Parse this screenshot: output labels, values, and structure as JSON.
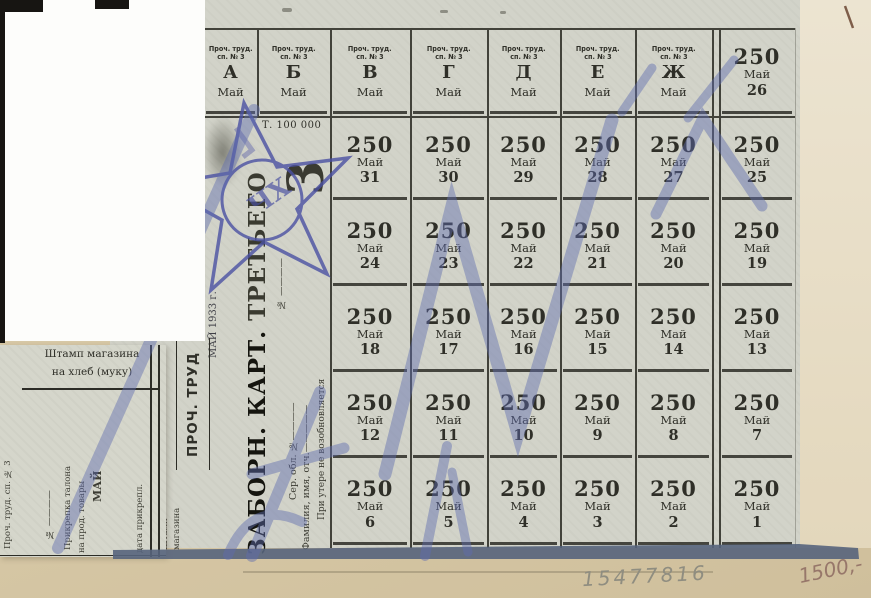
{
  "grid": {
    "small_header_line1": "Проч. труд.",
    "small_header_line2": "сп. № 3",
    "month": "Май",
    "ration": "250",
    "letters": [
      "А",
      "Б",
      "В",
      "Г",
      "Д",
      "Е",
      "Ж"
    ],
    "header_last_day": "26",
    "rows": [
      [
        "31",
        "30",
        "29",
        "28",
        "27",
        "25"
      ],
      [
        "24",
        "23",
        "22",
        "21",
        "20",
        "19"
      ],
      [
        "18",
        "17",
        "16",
        "15",
        "14",
        "13"
      ],
      [
        "12",
        "11",
        "10",
        "9",
        "8",
        "7"
      ],
      [
        "6",
        "5",
        "4",
        "3",
        "2",
        "1"
      ]
    ]
  },
  "title_strip": {
    "print_run": "Т. 100 000",
    "big_numeral": "3",
    "title_part1": "ЗАБОРН. КАРТ.",
    "title_part2": " ТРЕТЬЕГО",
    "number_line": "№ ————",
    "series_line": "Сер. обл. №————",
    "name_line": "Фамилия, имя, отч.—————",
    "warning_line": "При утере не возобновляется"
  },
  "middle": {
    "date_text": "МАЙ 1933 г.",
    "proch_trud": "ПРОЧ. ТРУД",
    "shop_stamp_line1": "Штамп",
    "shop_stamp_line2": "магазина"
  },
  "stub": {
    "header_line1": "Штамп магазина",
    "header_line2": "на хлеб (муку)",
    "left_vertical": "Проч. труд. сп. № 3",
    "number_line": "№ ————",
    "talon_line1": "Прикрепка талона",
    "talon_line2": "на прод. товары",
    "talon_month": "МАЙ",
    "date_line": "дата прикрепл."
  },
  "stamp": {
    "center_letters": "ЧХ"
  },
  "annotations": {
    "serial_number": "15477816",
    "price_note": "1500,-"
  },
  "colors": {
    "paper": "#d2d3c9",
    "print_ink": "#2f2f28",
    "stamp_ink": "#4b51a3",
    "stroke_ink": "#5f6cb0",
    "background": "#d6c7a5",
    "redaction": "#fdfdfb",
    "shadow": "#57647c"
  }
}
